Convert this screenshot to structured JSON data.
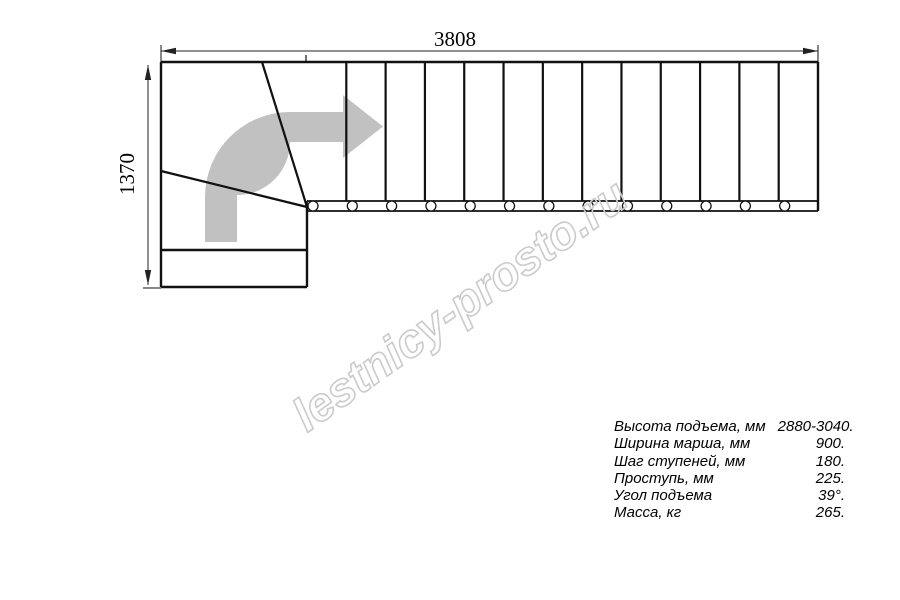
{
  "drawing": {
    "top_dimension_label": "3808",
    "left_dimension_label": "1370",
    "straight_tread_count": 13,
    "winder_tread_count": 3,
    "baluster_count": 13,
    "direction_arrow": "turn-right-arrow"
  },
  "specs": {
    "rows": [
      {
        "label": "Высота подъема, мм",
        "value": "2880-3040."
      },
      {
        "label": "Ширина марша, мм",
        "value": "900."
      },
      {
        "label": "Шаг ступеней, мм",
        "value": "180."
      },
      {
        "label": "Проступь, мм",
        "value": "225."
      },
      {
        "label": "Угол подъема",
        "value": "39°."
      },
      {
        "label": "Масса, кг",
        "value": "265."
      }
    ]
  },
  "watermark": {
    "text": "lestnicy-prosto.ru"
  },
  "colors": {
    "line": "#111111",
    "dimension": "#222222",
    "arrow_fill": "#c1c1c1",
    "watermark_stroke": "#cbcbcb",
    "background": "#ffffff"
  }
}
